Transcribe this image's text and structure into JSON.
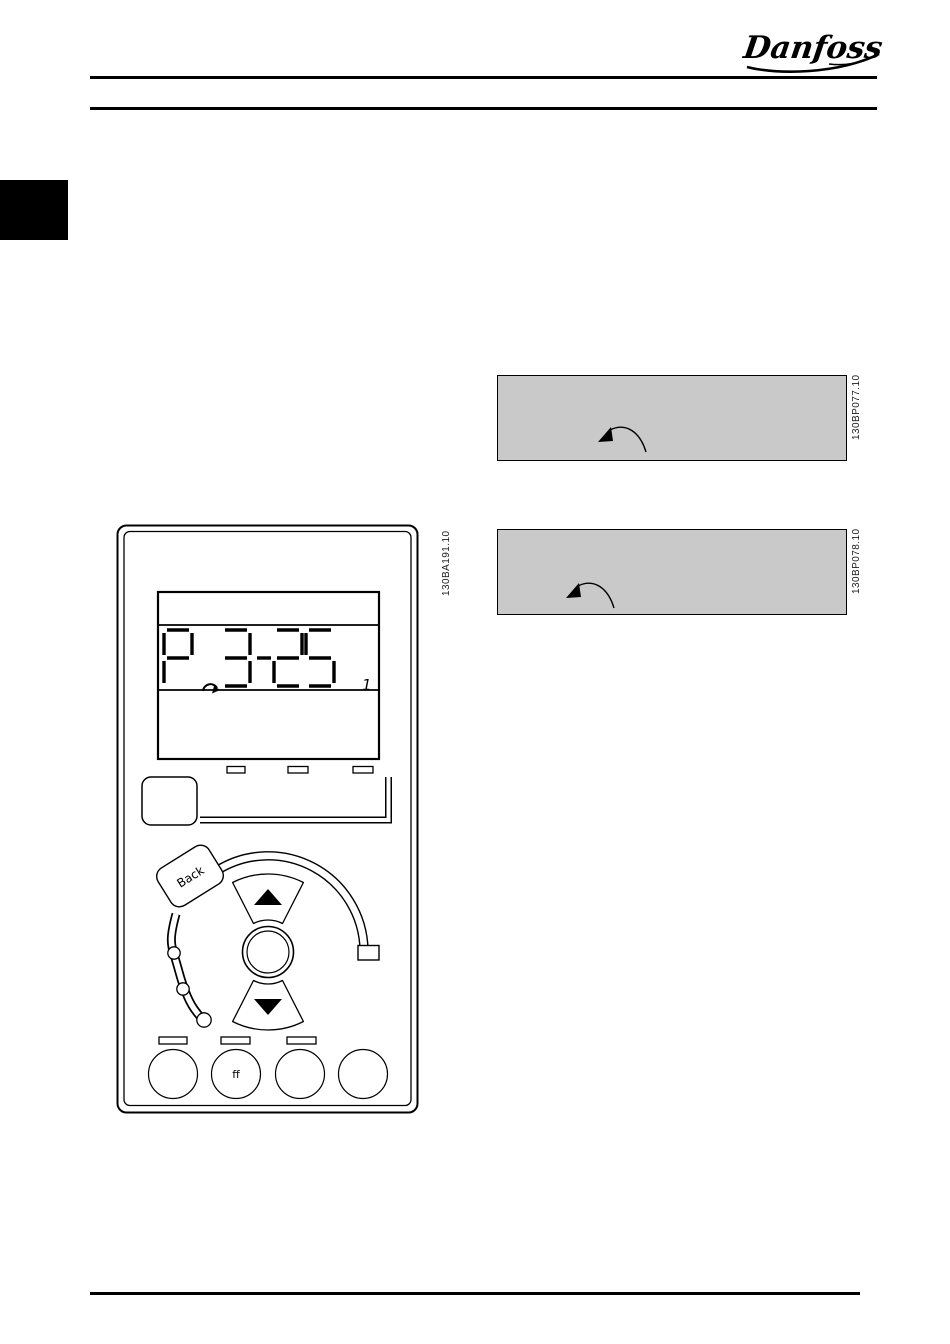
{
  "brand": {
    "logo_text": "Danfoss"
  },
  "figures": {
    "lcp_figure_id": "130BA191.10",
    "example1_figure_id": "130BP077.10",
    "example2_figure_id": "130BP078.10"
  },
  "lcp": {
    "display": {
      "parameter_text": "P 3-25",
      "chars": [
        "P",
        "3",
        "-",
        "2",
        "5"
      ],
      "setup_indicator": "1"
    },
    "back_button_label": "Back",
    "off_button_visible_text": "ff"
  },
  "colors": {
    "example_box_bg": "#c9c9c9",
    "ink": "#000000"
  }
}
